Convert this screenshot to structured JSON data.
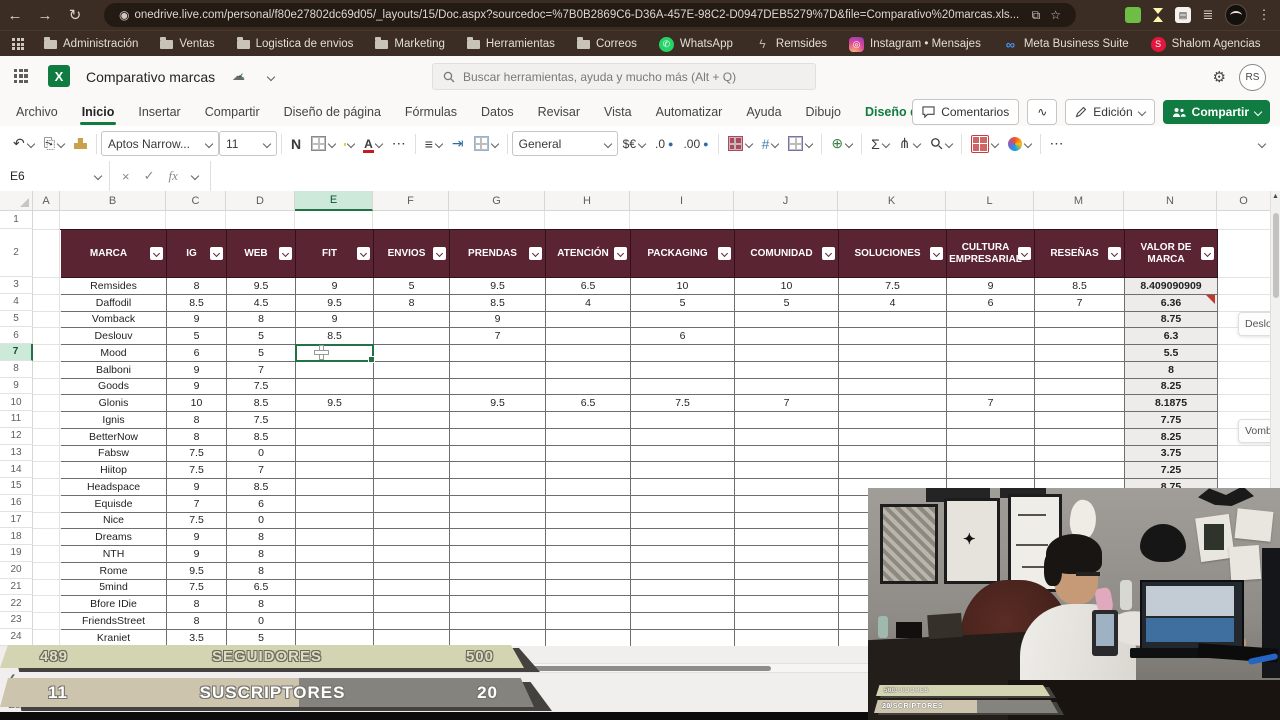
{
  "browser": {
    "back_icon": "←",
    "forward_icon": "→",
    "reload_icon": "↻",
    "url": "onedrive.live.com/personal/f80e27802dc69d05/_layouts/15/Doc.aspx?sourcedoc=%7B0B2869C6-D36A-457E-98C2-D0947DEB5279%7D&file=Comparativo%20marcas.xls...",
    "star_icon": "☆",
    "menu_icon": "⋮",
    "bookmarks": [
      {
        "id": "administracion",
        "label": "Administración",
        "icon": "folder"
      },
      {
        "id": "ventas",
        "label": "Ventas",
        "icon": "folder"
      },
      {
        "id": "logistica",
        "label": "Logistica de envios",
        "icon": "folder"
      },
      {
        "id": "marketing",
        "label": "Marketing",
        "icon": "folder"
      },
      {
        "id": "herramientas",
        "label": "Herramientas",
        "icon": "folder"
      },
      {
        "id": "correos",
        "label": "Correos",
        "icon": "folder"
      },
      {
        "id": "whatsapp",
        "label": "WhatsApp",
        "icon": "whatsapp",
        "glyph": "✆"
      },
      {
        "id": "remsides",
        "label": "Remsides",
        "icon": "remsides",
        "glyph": "ϟ"
      },
      {
        "id": "instagram",
        "label": "Instagram • Mensajes",
        "icon": "instagram",
        "glyph": "◎"
      },
      {
        "id": "meta",
        "label": "Meta Business Suite",
        "icon": "meta",
        "glyph": "∞"
      },
      {
        "id": "shalom",
        "label": "Shalom Agencias",
        "icon": "shalom",
        "glyph": "S"
      }
    ]
  },
  "header": {
    "app_glyph": "X",
    "title": "Comparativo marcas",
    "cloud_icon": "☁",
    "search_placeholder": "Buscar herramientas, ayuda y mucho más (Alt + Q)",
    "gear_icon": "⚙",
    "avatar": "RS"
  },
  "ribbon": {
    "tabs": [
      {
        "label": "Archivo"
      },
      {
        "label": "Inicio",
        "active": true
      },
      {
        "label": "Insertar"
      },
      {
        "label": "Compartir"
      },
      {
        "label": "Diseño de página"
      },
      {
        "label": "Fórmulas"
      },
      {
        "label": "Datos"
      },
      {
        "label": "Revisar"
      },
      {
        "label": "Vista"
      },
      {
        "label": "Automatizar"
      },
      {
        "label": "Ayuda"
      },
      {
        "label": "Dibujo"
      },
      {
        "label": "Diseño de tabla",
        "contextual": true
      }
    ],
    "comments_label": "Comentarios",
    "catchup_icon": "∿",
    "edit_label": "Edición",
    "share_label": "Compartir"
  },
  "toolbar": {
    "undo_icon": "↶",
    "font_name": "Aptos Narrow...",
    "font_size": "11",
    "bold_label": "N",
    "more_icon": "⋯",
    "align_icon": "≡",
    "number_format": "General",
    "currency_label": "$€",
    "dec_decimal": ".0",
    "inc_decimal": ".00",
    "sum_icon": "Σ",
    "collapse_icon_note": "chevron"
  },
  "formula_bar": {
    "name_box": "E6",
    "cancel_icon": "×",
    "enter_icon": "✓",
    "fx_label": "fx",
    "formula_value": ""
  },
  "sheet": {
    "columns": [
      {
        "l": "A",
        "x": 33,
        "w": 27
      },
      {
        "l": "B",
        "x": 60,
        "w": 106
      },
      {
        "l": "C",
        "x": 166,
        "w": 60
      },
      {
        "l": "D",
        "x": 226,
        "w": 69
      },
      {
        "l": "E",
        "x": 295,
        "w": 78
      },
      {
        "l": "F",
        "x": 373,
        "w": 76
      },
      {
        "l": "G",
        "x": 449,
        "w": 96
      },
      {
        "l": "H",
        "x": 545,
        "w": 85
      },
      {
        "l": "I",
        "x": 630,
        "w": 104
      },
      {
        "l": "J",
        "x": 734,
        "w": 104
      },
      {
        "l": "K",
        "x": 838,
        "w": 108
      },
      {
        "l": "L",
        "x": 946,
        "w": 88
      },
      {
        "l": "M",
        "x": 1034,
        "w": 90
      },
      {
        "l": "N",
        "x": 1124,
        "w": 93
      },
      {
        "l": "O",
        "x": 1217,
        "w": 54
      }
    ],
    "visible_rows": 24,
    "selected_column": "E",
    "selected_row": 7,
    "table": {
      "headers": [
        "MARCA",
        "IG",
        "WEB",
        "FIT",
        "ENVIOS",
        "PRENDAS",
        "ATENCIÓN",
        "PACKAGING",
        "COMUNIDAD",
        "SOLUCIONES",
        "CULTURA EMPRESARIAL",
        "RESEÑAS",
        "VALOR DE MARCA"
      ],
      "rows": [
        [
          "Remsides",
          "8",
          "9.5",
          "9",
          "5",
          "9.5",
          "6.5",
          "10",
          "10",
          "7.5",
          "9",
          "8.5",
          "8.409090909"
        ],
        [
          "Daffodil",
          "8.5",
          "4.5",
          "9.5",
          "8",
          "8.5",
          "4",
          "5",
          "5",
          "4",
          "6",
          "7",
          "6.36"
        ],
        [
          "Vomback",
          "9",
          "8",
          "9",
          "",
          "9",
          "",
          "",
          "",
          "",
          "",
          "",
          "8.75"
        ],
        [
          "Deslouv",
          "5",
          "5",
          "8.5",
          "",
          "7",
          "",
          "6",
          "",
          "",
          "",
          "",
          "6.3"
        ],
        [
          "Mood",
          "6",
          "5",
          "",
          "",
          "",
          "",
          "",
          "",
          "",
          "",
          "",
          "5.5"
        ],
        [
          "Balboni",
          "9",
          "7",
          "",
          "",
          "",
          "",
          "",
          "",
          "",
          "",
          "",
          "8"
        ],
        [
          "Goods",
          "9",
          "7.5",
          "",
          "",
          "",
          "",
          "",
          "",
          "",
          "",
          "",
          "8.25"
        ],
        [
          "Glonis",
          "10",
          "8.5",
          "9.5",
          "",
          "9.5",
          "6.5",
          "7.5",
          "7",
          "",
          "7",
          "",
          "8.1875"
        ],
        [
          "Ignis",
          "8",
          "7.5",
          "",
          "",
          "",
          "",
          "",
          "",
          "",
          "",
          "",
          "7.75"
        ],
        [
          "BetterNow",
          "8",
          "8.5",
          "",
          "",
          "",
          "",
          "",
          "",
          "",
          "",
          "",
          "8.25"
        ],
        [
          "Fabsw",
          "7.5",
          "0",
          "",
          "",
          "",
          "",
          "",
          "",
          "",
          "",
          "",
          "3.75"
        ],
        [
          "Hiitop",
          "7.5",
          "7",
          "",
          "",
          "",
          "",
          "",
          "",
          "",
          "",
          "",
          "7.25"
        ],
        [
          "Headspace",
          "9",
          "8.5",
          "",
          "",
          "",
          "",
          "",
          "",
          "",
          "",
          "",
          "8.75"
        ],
        [
          "Equisde",
          "7",
          "6",
          "",
          "",
          "",
          "",
          "",
          "",
          "",
          "",
          "",
          ""
        ],
        [
          "Nice",
          "7.5",
          "0",
          "",
          "",
          "",
          "",
          "",
          "",
          "",
          "",
          "",
          ""
        ],
        [
          "Dreams",
          "9",
          "8",
          "",
          "",
          "",
          "",
          "",
          "",
          "",
          "",
          "",
          ""
        ],
        [
          "NTH",
          "9",
          "8",
          "",
          "",
          "",
          "",
          "",
          "",
          "",
          "",
          "",
          ""
        ],
        [
          "Rome",
          "9.5",
          "8",
          "",
          "",
          "",
          "",
          "",
          "",
          "",
          "",
          "",
          ""
        ],
        [
          "5mind",
          "7.5",
          "6.5",
          "",
          "",
          "",
          "",
          "",
          "",
          "",
          "",
          "",
          ""
        ],
        [
          "Bfore IDie",
          "8",
          "8",
          "",
          "",
          "",
          "",
          "",
          "",
          "",
          "",
          "",
          ""
        ],
        [
          "FriendsStreet",
          "8",
          "0",
          "",
          "",
          "",
          "",
          "",
          "",
          "",
          "",
          "",
          ""
        ],
        [
          "Kraniet",
          "3.5",
          "5",
          "",
          "",
          "",
          "",
          "",
          "",
          "",
          "",
          "",
          ""
        ]
      ],
      "header_bg": "#5b2432",
      "valor_col_bg": "#edecea"
    },
    "comment_cards": [
      "Deslou",
      "Vombac"
    ]
  },
  "overlays": {
    "seguidores": {
      "value": "489",
      "label": "SEGUIDORES",
      "max": "500"
    },
    "suscriptores": {
      "value": "11",
      "label": "SUSCRIPTORES",
      "max": "20"
    },
    "accent_beige": "#d3d4b2",
    "accent_gray": "#85837e"
  },
  "status_bar": {
    "text": "Estadísticas del libro"
  }
}
